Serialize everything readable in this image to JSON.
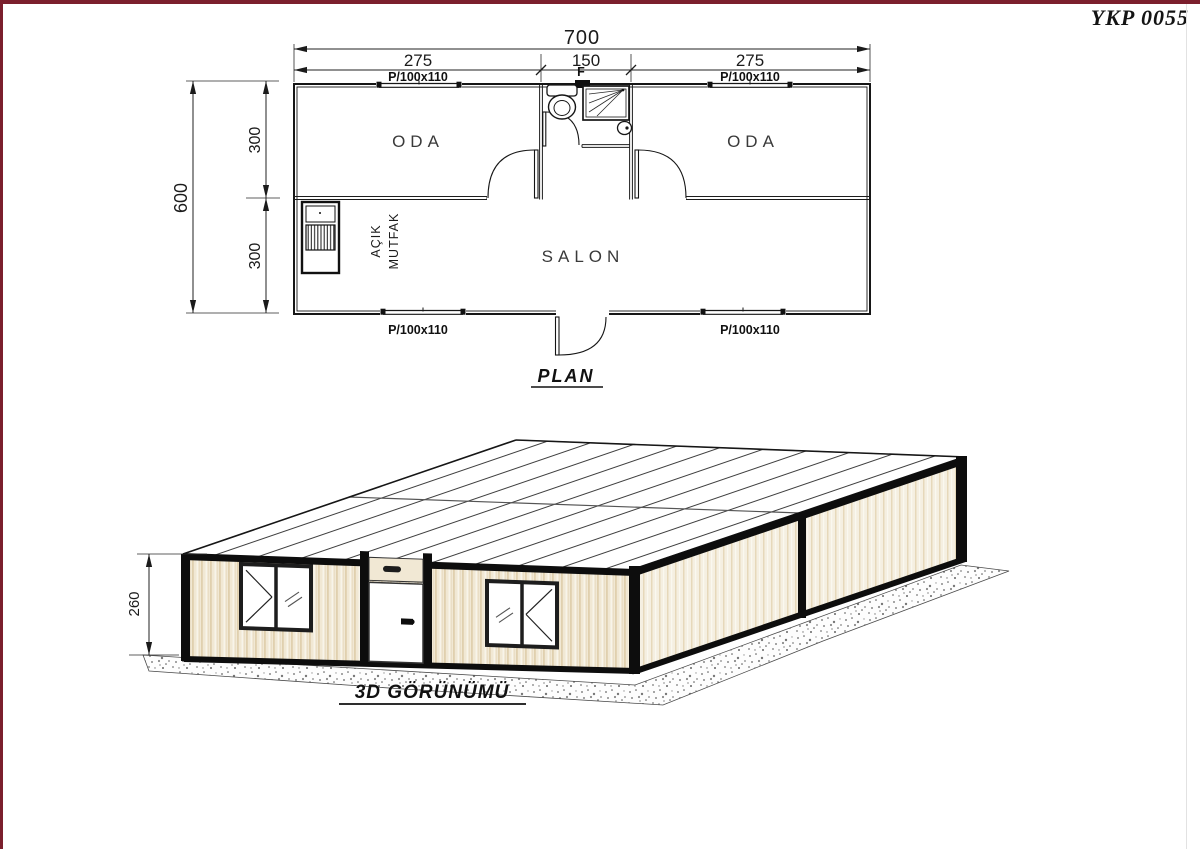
{
  "page": {
    "title": "YKP 0055"
  },
  "plan": {
    "section_label": "PLAN",
    "dim_total_width": "700",
    "dim_left": "275",
    "dim_mid": "150",
    "dim_right": "275",
    "dim_total_height": "600",
    "dim_top_half": "300",
    "dim_bottom_half": "300",
    "window_label": "P/100x110",
    "bath_window_label": "F",
    "room_left": "ODA",
    "room_right": "ODA",
    "room_salon": "SALON",
    "kitchen_word1": "AÇIK",
    "kitchen_word2": "MUTFAK"
  },
  "view3d": {
    "section_label": "3D GÖRÜNÜMÜ",
    "dim_height": "260"
  },
  "colors": {
    "frame_accent": "#7b1f2d",
    "siding_cream": "#f1e8d4",
    "line_black": "#161616"
  }
}
